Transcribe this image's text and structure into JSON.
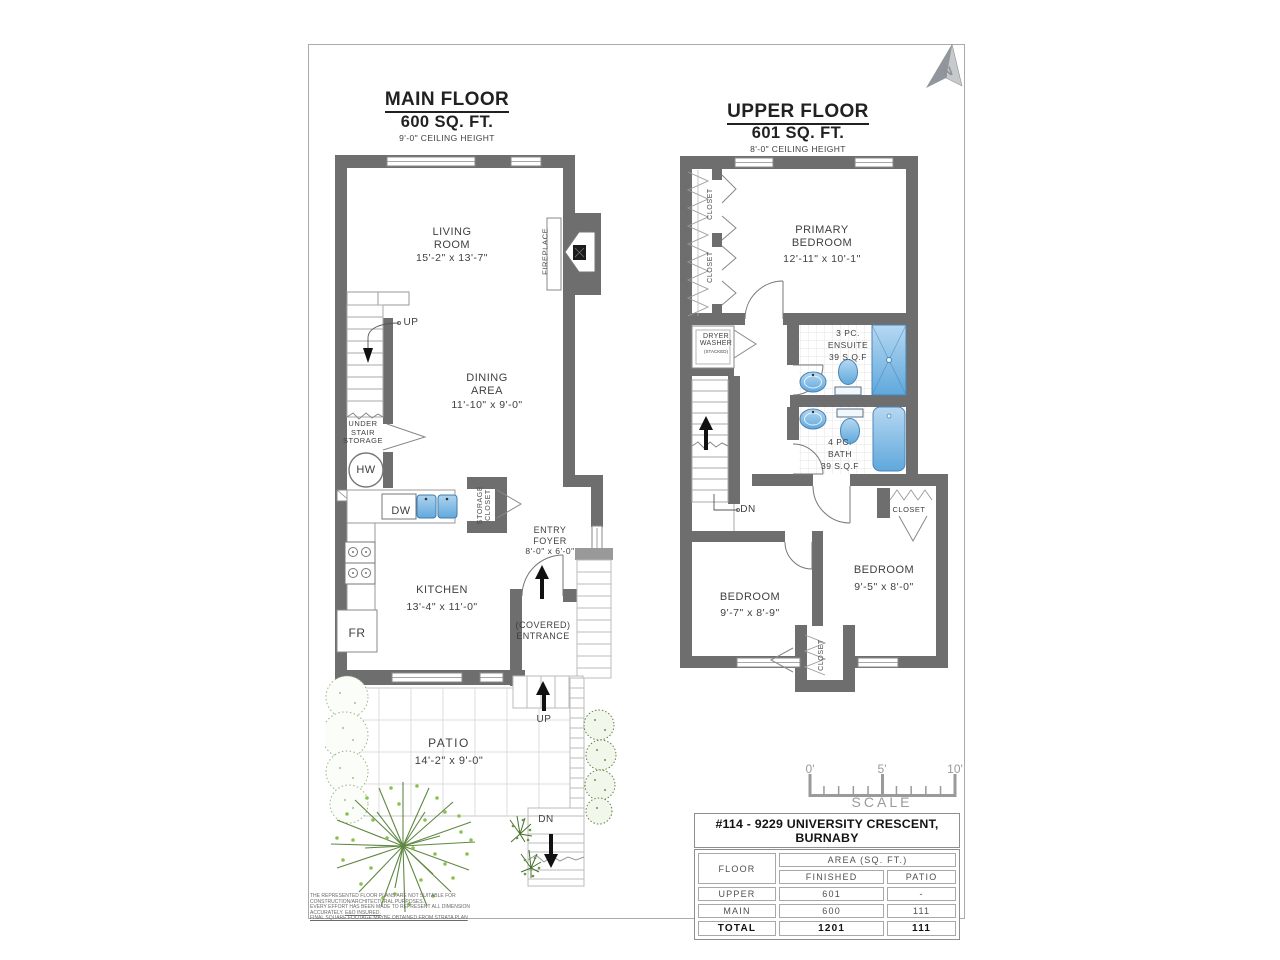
{
  "page": {
    "north": "N",
    "disclaimer": {
      "line1": "THE REPRESENTED FLOOR PLANS ARE NOT SUITABLE FOR CONSTRUCTION/ARCHITECTURAL PURPOSES.",
      "line2": "EVERY EFFORT HAS BEEN MADE TO REPRESENT ALL DIMENSION ACCURATELY. ",
      "line2_underlined": "E&O INSURED.",
      "line3": "FINAL SQUARE FOOTAGE MAYBE OBTAINED FROM STRATA PLAN"
    }
  },
  "main_floor": {
    "title": "MAIN FLOOR",
    "area": "600 SQ. FT.",
    "ceiling": "9'-0\" CEILING HEIGHT",
    "living_room": {
      "name": "LIVING\nROOM",
      "dims": "15'-2\" x 13'-7\""
    },
    "dining_area": {
      "name": "DINING\nAREA",
      "dims": "11'-10\" x 9'-0\""
    },
    "kitchen": {
      "name": "KITCHEN",
      "dims": "13'-4\" x 11'-0\""
    },
    "entry_foyer": {
      "name": "ENTRY\nFOYER",
      "dims": "8'-0\" x 6'-0\""
    },
    "covered_entrance": "(COVERED)\nENTRANCE",
    "fireplace": "FIREPLACE",
    "under_stair_storage": "UNDER\nSTAIR\nSTORAGE",
    "storage_closet": "STORAGE\nCLOSET",
    "up": "UP",
    "hw": "HW",
    "dw": "DW",
    "fr": "FR"
  },
  "patio": {
    "name": "PATIO",
    "dims": "14'-2\" x 9'-0\"",
    "up": "UP",
    "dn": "DN"
  },
  "upper_floor": {
    "title": "UPPER FLOOR",
    "area": "601 SQ. FT.",
    "ceiling": "8'-0\" CEILING HEIGHT",
    "primary_bedroom": {
      "name": "PRIMARY\nBEDROOM",
      "dims": "12'-11\" x 10'-1\""
    },
    "bedroom_left": {
      "name": "BEDROOM",
      "dims": "9'-7\" x 8'-9\""
    },
    "bedroom_right": {
      "name": "BEDROOM",
      "dims": "9'-5\" x 8'-0\""
    },
    "ensuite": "3 PC.\nENSUITE\n39 S.Q.F",
    "bath": "4 PC.\nBATH\n39 S.Q.F",
    "laundry": {
      "line1": "DRYER",
      "line2": "WASHER",
      "line3": "(STACKED)"
    },
    "closet": "CLOSET",
    "dn": "DN"
  },
  "scale_bar": {
    "tick0": "0'",
    "tick5": "5'",
    "tick10": "10'",
    "label": "SCALE"
  },
  "area_table": {
    "title": "#114 - 9229 UNIVERSITY CRESCENT, BURNABY",
    "col_floor": "FLOOR",
    "col_area": "AREA (SQ. FT.)",
    "col_finished": "FINISHED",
    "col_patio": "PATIO",
    "rows": [
      {
        "floor": "UPPER",
        "finished": "601",
        "patio": "-"
      },
      {
        "floor": "MAIN",
        "finished": "600",
        "patio": "111"
      },
      {
        "floor": "TOTAL",
        "finished": "1201",
        "patio": "111"
      }
    ]
  },
  "colors": {
    "wall": "#6e6e6e",
    "fixture_blue": "#62a9dc",
    "tree_green": "#4e7b2e",
    "scale_grey": "#9a9a9a"
  }
}
